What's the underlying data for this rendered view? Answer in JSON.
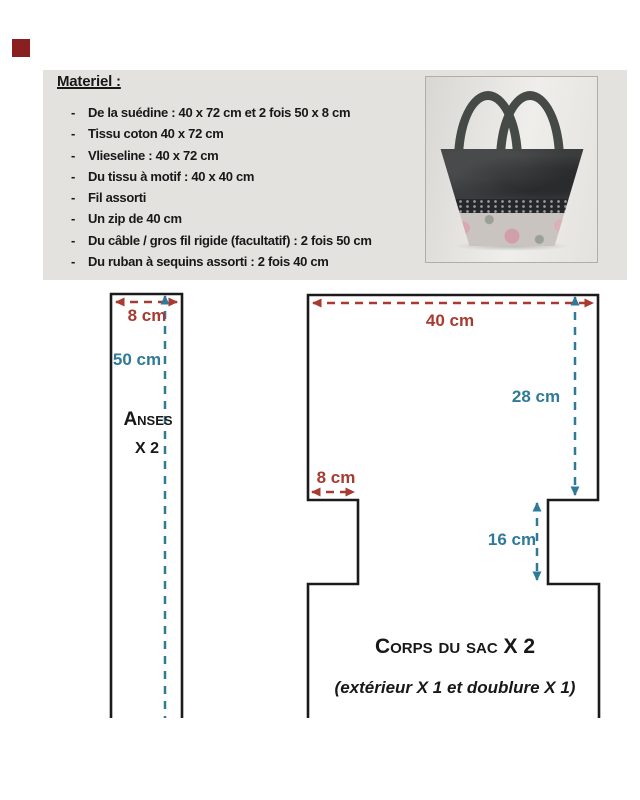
{
  "colors": {
    "dim_red": "#a83a31",
    "dim_teal": "#2f7a98",
    "outline": "#1b1b1b",
    "box_bg": "#e3e2df",
    "marker_red": "#8b1e1e",
    "text_black": "#181818"
  },
  "materials": {
    "title": "Materiel :",
    "bullet": "-",
    "items": [
      "De la suédine : 40 x 72 cm et 2 fois 50 x 8 cm",
      "Tissu coton 40 x 72 cm",
      "Vlieseline : 40 x 72 cm",
      "Du tissu à motif : 40 x 40 cm",
      "Fil assorti",
      "Un zip de 40 cm",
      "Du câble / gros fil rigide (facultatif) : 2 fois 50 cm",
      "Du ruban à sequins assorti : 2 fois 40 cm"
    ]
  },
  "diagrams": {
    "anses": {
      "width_label": "8 cm",
      "length_label": "50 cm",
      "title": "Anses",
      "count": "X 2"
    },
    "corps": {
      "width_label": "40 cm",
      "height_label": "28 cm",
      "notch_width_label": "8 cm",
      "notch_height_label": "16 cm",
      "title": "Corps du sac X 2",
      "subtitle": "(extérieur X 1 et doublure X 1)"
    }
  }
}
